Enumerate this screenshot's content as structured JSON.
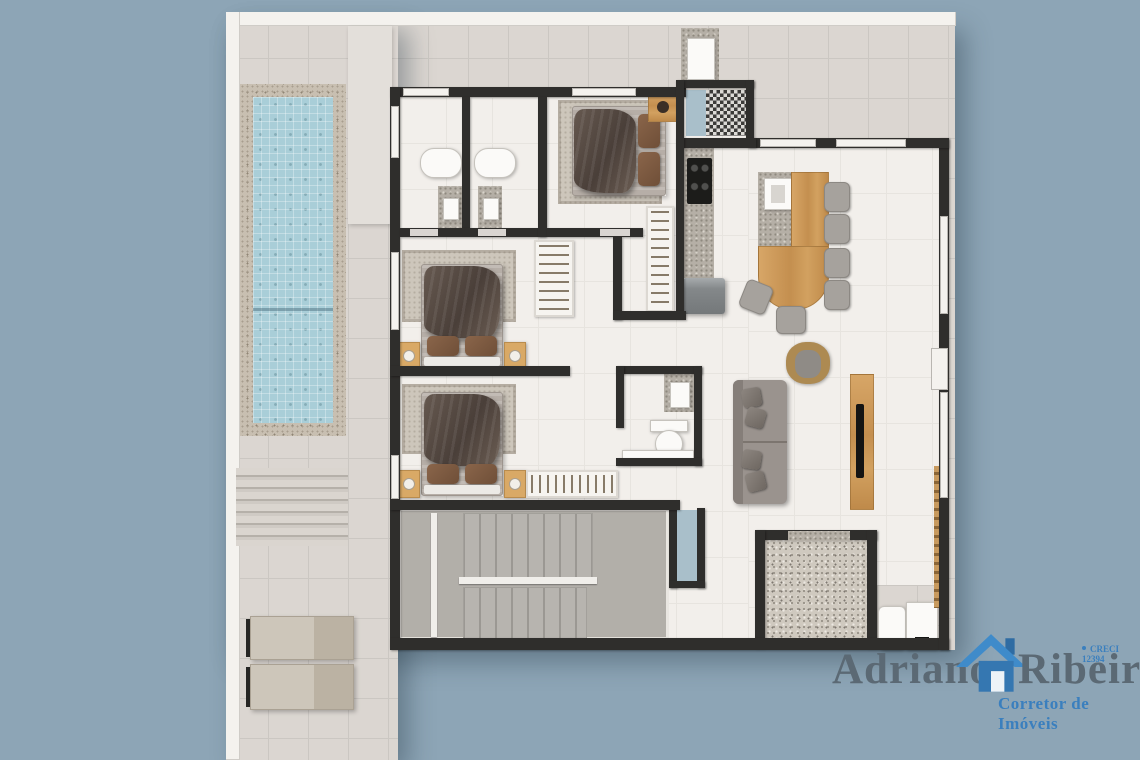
{
  "watermark": {
    "name_first": "Adriano",
    "name_last": "Ribeiro",
    "tagline": "Corretor de Imóveis",
    "license": "CRECI 12394",
    "icon": "house-icon"
  },
  "colors": {
    "background": "#8da5b6",
    "deck": "#dbd6d1",
    "deck-line": "#cbc7c2",
    "floor": "#f2efeb",
    "floor-line": "#e7e4df",
    "wall": "#2f2e2c",
    "wall-light": "#f4f2ee",
    "pool-water": "#a9ced8",
    "stone": "#c8bfb1",
    "wood": "#d19e5e",
    "stair": "#b2afa9",
    "sofa": "#9a938e",
    "granite": "#b5afa6",
    "terrazzo": "#cfc9bf",
    "tan": "#d9a966",
    "logo-gray": "#5b6974",
    "logo-blue": "#3a7fbe"
  }
}
